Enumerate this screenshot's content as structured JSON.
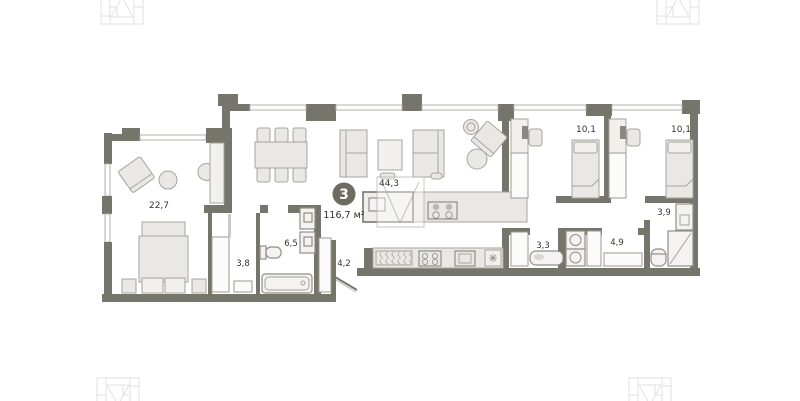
{
  "plan": {
    "type": "apartment-floor-plan",
    "badge": {
      "number": "3",
      "total_area": "116,7 м²"
    },
    "rooms": [
      {
        "name": "master-bedroom",
        "area": "22,7"
      },
      {
        "name": "living-kitchen",
        "area": "44,3"
      },
      {
        "name": "bedroom-1",
        "area": "10,1"
      },
      {
        "name": "bedroom-2",
        "area": "10,1"
      },
      {
        "name": "walk-in-closet",
        "area": "3,8"
      },
      {
        "name": "bathroom",
        "area": "6,5"
      },
      {
        "name": "hallway",
        "area": "4,2"
      },
      {
        "name": "bathroom-2",
        "area": "3,3"
      },
      {
        "name": "laundry",
        "area": "4,9"
      },
      {
        "name": "shower-room",
        "area": "3,9"
      }
    ],
    "colors": {
      "wall": "#76756c",
      "badge_fill": "#6d6c63",
      "badge_text": "#ffffff",
      "furniture_fill": "#e9e8e5",
      "furniture_stroke": "#a5a49d",
      "window_line": "#b2b1ab",
      "label_text": "#35352f",
      "logo_line": "#e2e2e0"
    }
  }
}
